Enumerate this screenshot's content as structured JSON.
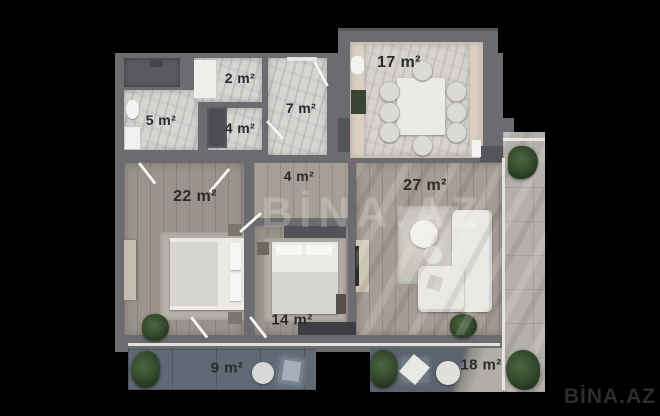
{
  "watermarks": {
    "center": "BİNA.AZ",
    "corner": "BİNA.AZ"
  },
  "rooms": {
    "closet": {
      "label": "2 m²"
    },
    "bathroom": {
      "label": "5 m²"
    },
    "hall": {
      "label": "4 m²"
    },
    "hallway": {
      "label": "7 m²"
    },
    "kitchen": {
      "label": "17 m²"
    },
    "bedroom_main": {
      "label": "22 m²"
    },
    "corridor": {
      "label": "4 m²"
    },
    "living_room": {
      "label": "27 m²"
    },
    "bedroom_second": {
      "label": "14 m²"
    },
    "balcony": {
      "label": "9 m²"
    },
    "terrace": {
      "label": "18 m²"
    }
  },
  "colors": {
    "background": "#000000",
    "wall": "#6b6b70",
    "wood_floor": "#98918a",
    "marble_floor": "#d7d5d2",
    "kitchen_floor": "#dacfc0",
    "slate_tile": "#5a636e",
    "concrete": "#b1aea8",
    "label_text": "#2b2b2e",
    "watermark_center": "rgba(255,255,255,0.22)",
    "watermark_corner": "#2d2d2f"
  }
}
